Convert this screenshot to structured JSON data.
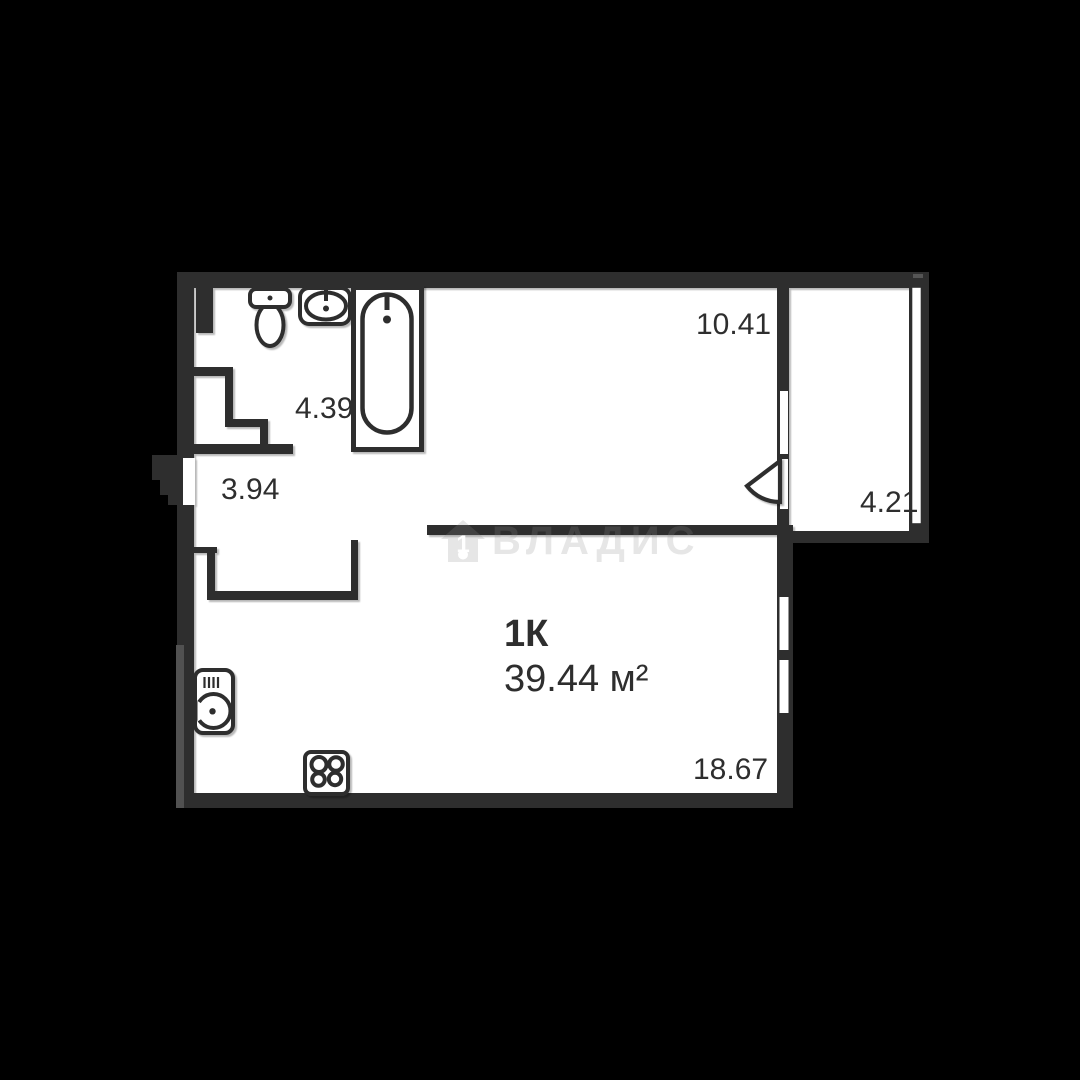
{
  "plan": {
    "title_room_count": "1К",
    "title_area": "39.44 м²",
    "room_areas": {
      "top_room": "10.41",
      "bathroom": "4.39",
      "hallway": "3.94",
      "balcony": "4.21",
      "living_room": "18.67"
    },
    "watermark_text": "ВЛАДИС",
    "watermark_house_digit": "1",
    "fixtures": [
      "toilet",
      "sink",
      "bathtub",
      "washing-machine",
      "stove"
    ],
    "colors": {
      "background": "#000000",
      "wall": "#2e2e2e",
      "floor": "#ffffff",
      "label": "#2e2e2e",
      "watermark": "rgba(140,140,140,0.22)"
    }
  }
}
